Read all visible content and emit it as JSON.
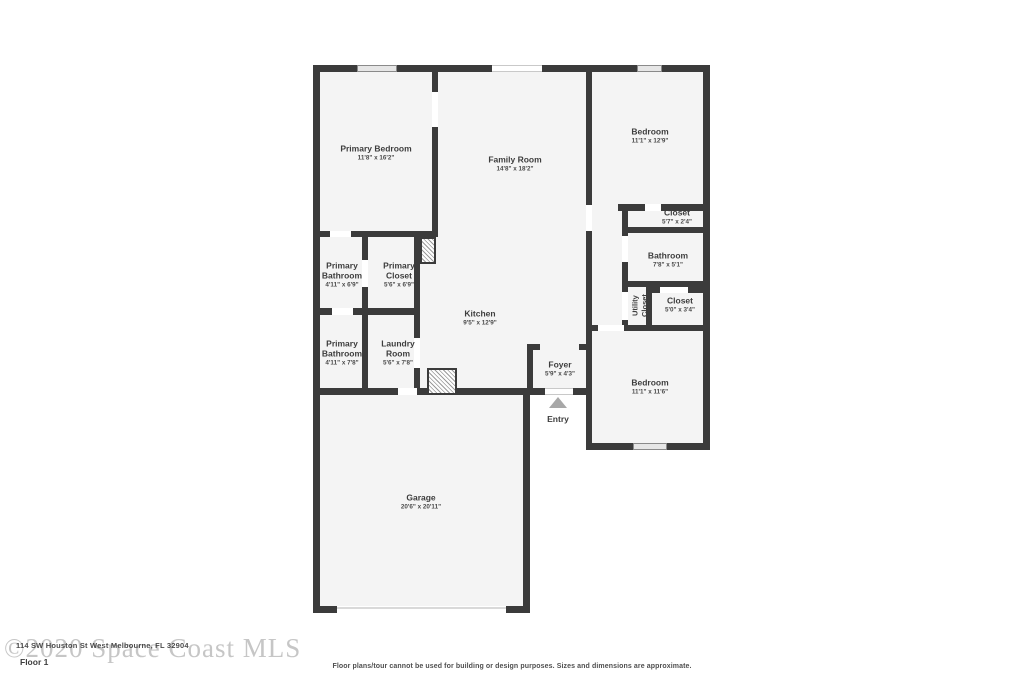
{
  "colors": {
    "wall": "#3b3b3b",
    "room_fill": "#f4f4f4",
    "label_text": "#3d3d3d",
    "window_fill": "#e6e6e6",
    "entry_arrow": "#a8a8a8",
    "watermark": "#c6c6c6"
  },
  "rooms": [
    {
      "name": "Primary Bedroom",
      "dims": "11'8\" x 16'2\""
    },
    {
      "name": "Family Room",
      "dims": "14'8\" x 18'2\""
    },
    {
      "name": "Bedroom",
      "dims": "11'1\" x 12'9\""
    },
    {
      "name": "Closet",
      "dims": "5'7\" x 2'4\""
    },
    {
      "name": "Bathroom",
      "dims": "7'8\" x 5'1\""
    },
    {
      "name": "Utility Closet",
      "dims": ""
    },
    {
      "name": "Closet",
      "dims": "5'0\" x 3'4\""
    },
    {
      "name": "Primary Bathroom",
      "dims": "4'11\" x 6'9\""
    },
    {
      "name": "Primary Closet",
      "dims": "5'6\" x 6'9\""
    },
    {
      "name": "Kitchen",
      "dims": "9'5\" x 12'9\""
    },
    {
      "name": "Primary Bathroom",
      "dims": "4'11\" x 7'8\""
    },
    {
      "name": "Laundry Room",
      "dims": "5'6\" x 7'8\""
    },
    {
      "name": "Foyer",
      "dims": "5'9\" x 4'3\""
    },
    {
      "name": "Bedroom",
      "dims": "11'1\" x 11'6\""
    },
    {
      "name": "Garage",
      "dims": "20'6\" x 20'11\""
    }
  ],
  "entry": {
    "label": "Entry"
  },
  "footer": {
    "floor_label": "Floor 1",
    "watermark": "©2020 Space Coast MLS",
    "address": "114 SW Houston St West Melbourne, FL 32904",
    "disclaimer": "Floor plans/tour cannot be used for building or design purposes. Sizes and dimensions are approximate."
  }
}
